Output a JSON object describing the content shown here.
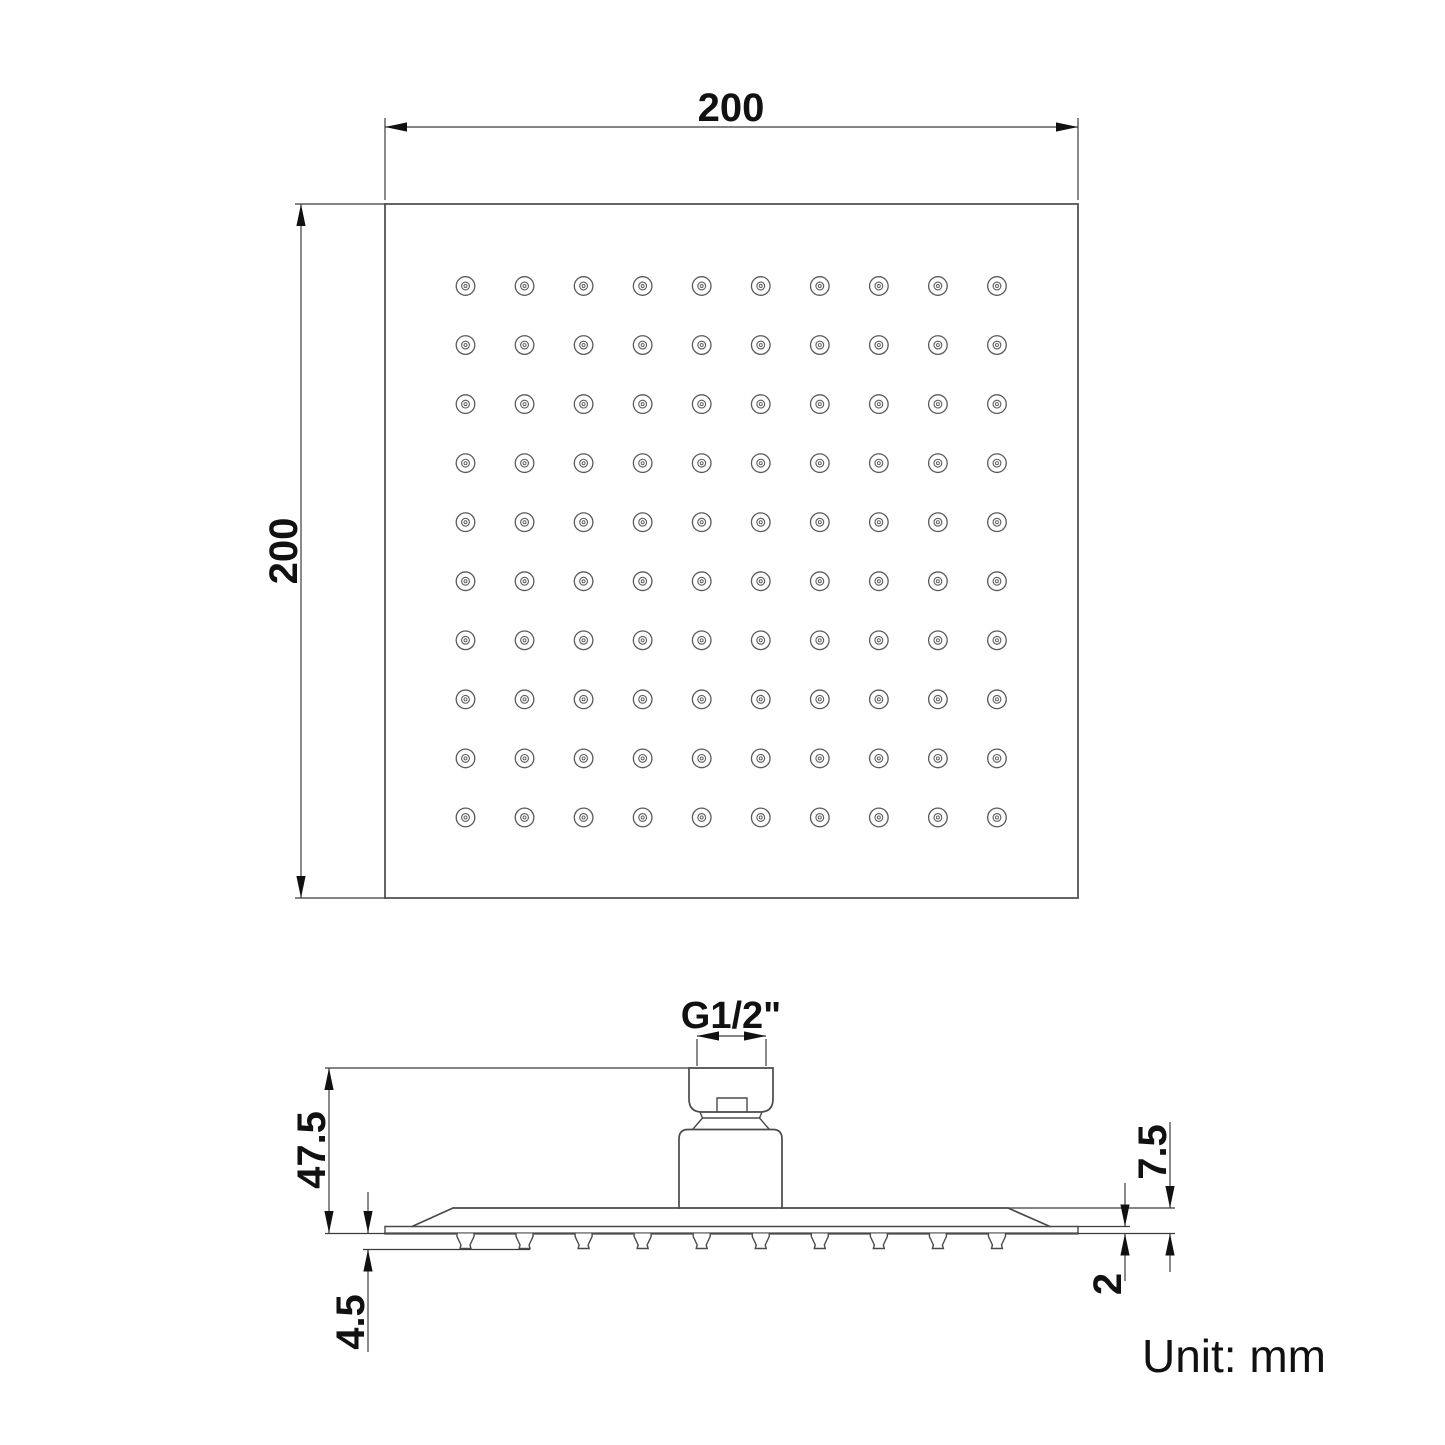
{
  "drawing": {
    "unit_note": "Unit: mm",
    "top_view": {
      "width_dim_label": "200",
      "height_dim_label": "200",
      "nozzle_grid": {
        "rows": 10,
        "cols": 10
      }
    },
    "side_view": {
      "thread_label": "G1/2\"",
      "overall_height_dim_label": "47.5",
      "nozzle_height_dim_label": "4.5",
      "rim_height_dim_label": "7.5",
      "plate_thickness_dim_label": "2",
      "nozzle_count": 10
    },
    "colors": {
      "background": "#ffffff",
      "outline": "#4a4a4a",
      "dimension": "#3c3c3c",
      "text": "#111111"
    }
  }
}
